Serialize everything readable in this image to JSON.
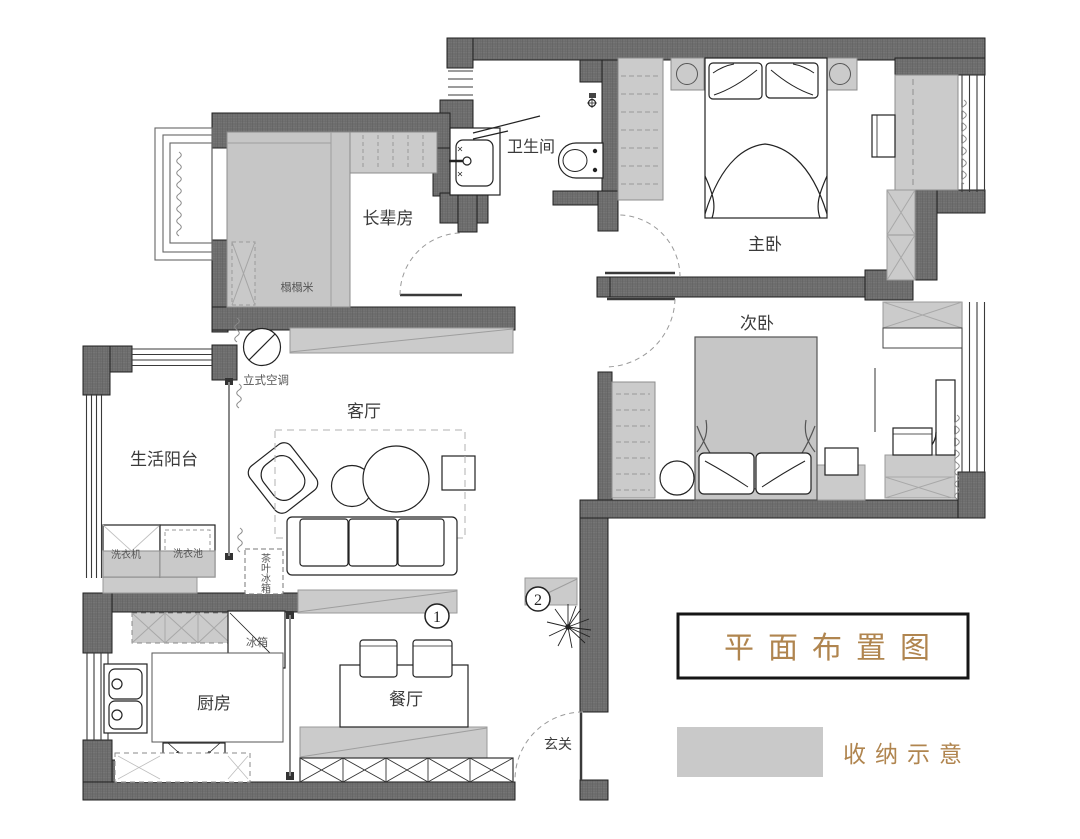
{
  "title": {
    "text": "平面布置图"
  },
  "legend": {
    "label": "收纳示意",
    "swatch_color": "#c9c9c9"
  },
  "rooms": [
    {
      "id": "bathroom",
      "label": "卫生间"
    },
    {
      "id": "master-bedroom",
      "label": "主卧"
    },
    {
      "id": "second-bedroom",
      "label": "次卧"
    },
    {
      "id": "elders-room",
      "label": "长辈房"
    },
    {
      "id": "living-room",
      "label": "客厅"
    },
    {
      "id": "service-balcony",
      "label": "生活阳台"
    },
    {
      "id": "kitchen",
      "label": "厨房"
    },
    {
      "id": "dining-room",
      "label": "餐厅"
    },
    {
      "id": "entryway",
      "label": "玄关"
    }
  ],
  "furniture_labels": [
    {
      "id": "tatami",
      "label": "榻榻米"
    },
    {
      "id": "standing-ac",
      "label": "立式空调"
    },
    {
      "id": "washing-machine",
      "label": "洗衣机"
    },
    {
      "id": "laundry-sink",
      "label": "洗衣池"
    },
    {
      "id": "tea-fridge",
      "label": "茶叶冰箱"
    },
    {
      "id": "fridge",
      "label": "冰箱"
    }
  ],
  "markers": [
    {
      "n": "1"
    },
    {
      "n": "2"
    }
  ],
  "colors": {
    "wall": "#6e6e6e",
    "storage": "#cbcbcb",
    "accent_text": "#b0854f",
    "outline": "#222222"
  }
}
